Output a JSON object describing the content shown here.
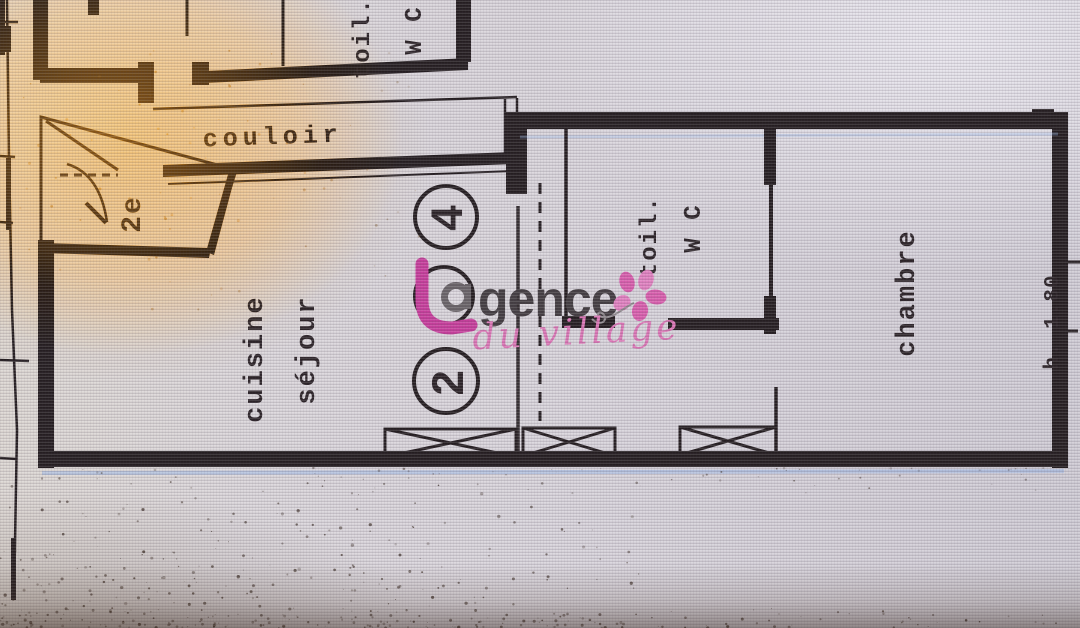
{
  "plan": {
    "floor_label": "2e",
    "rooms": {
      "toilet_top": {
        "lines": [
          "toil.",
          "W C"
        ]
      },
      "corridor": {
        "label": "couloir"
      },
      "kitchen_living": {
        "lines": [
          "cuisine",
          "séjour"
        ]
      },
      "toilet_main": {
        "lines": [
          "toil.",
          "W C"
        ]
      },
      "bedroom": {
        "label": "chambre"
      }
    },
    "annotations": {
      "circled_top": "4",
      "circled_bottom": "2",
      "height_note": "h. 1.80"
    }
  },
  "watermark": {
    "brand_name": "L'agence",
    "brand_visible_text": "gence",
    "tagline": "du village",
    "colors": {
      "pink": "#c73e9c",
      "grey": "#433d41",
      "tagline_pink": "#db76b6"
    }
  },
  "palette": {
    "ink": "#241d20",
    "paper": "#d7d3da",
    "glare": "#c07812"
  }
}
